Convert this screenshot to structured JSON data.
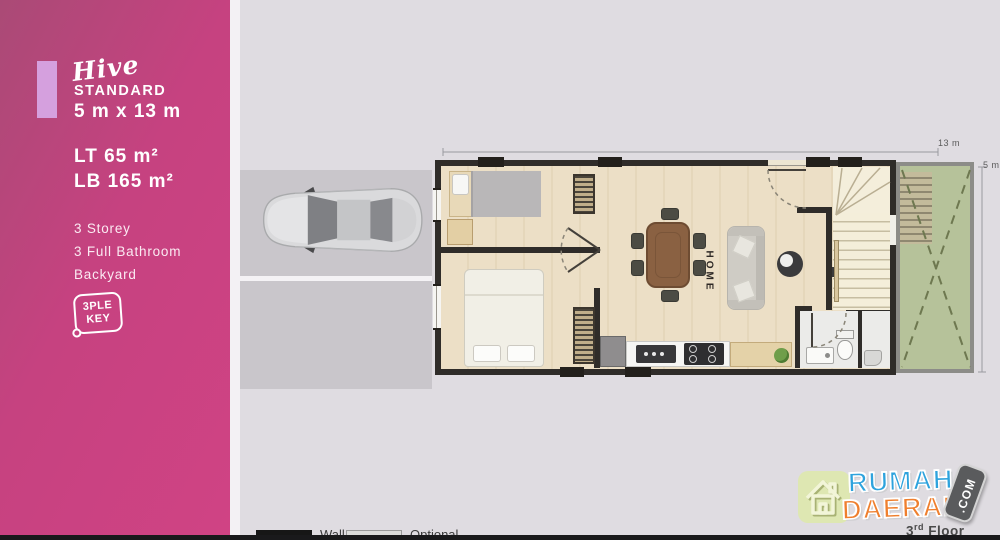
{
  "panel": {
    "brand_script": "Hive",
    "tier": "STANDARD",
    "dimensions": "5 m x 13 m",
    "land_area": "LT 65 m²",
    "building_area": "LB 165 m²",
    "features": [
      "3 Storey",
      "3 Full Bathroom",
      "Backyard"
    ],
    "badge": {
      "line1": "3PLE",
      "line2": "KEY"
    }
  },
  "plan": {
    "width_dim": "13 m",
    "height_dim": "5 m",
    "home_label": "HOME",
    "floor": {
      "number": "3",
      "suffix": "rd",
      "word": " Floor"
    }
  },
  "legend": {
    "wall": "Wall",
    "optional": "Optional"
  },
  "logo": {
    "word1": "RUMAH",
    "word2": "DAERAH",
    "tld": ".COM"
  },
  "colors": {
    "accent_pink": "#c64280",
    "accent_lilac": "#d5a0de",
    "backyard_green": "#b6c29a",
    "logo_blue": "#2ea3dd",
    "logo_orange": "#ef7f2e"
  }
}
